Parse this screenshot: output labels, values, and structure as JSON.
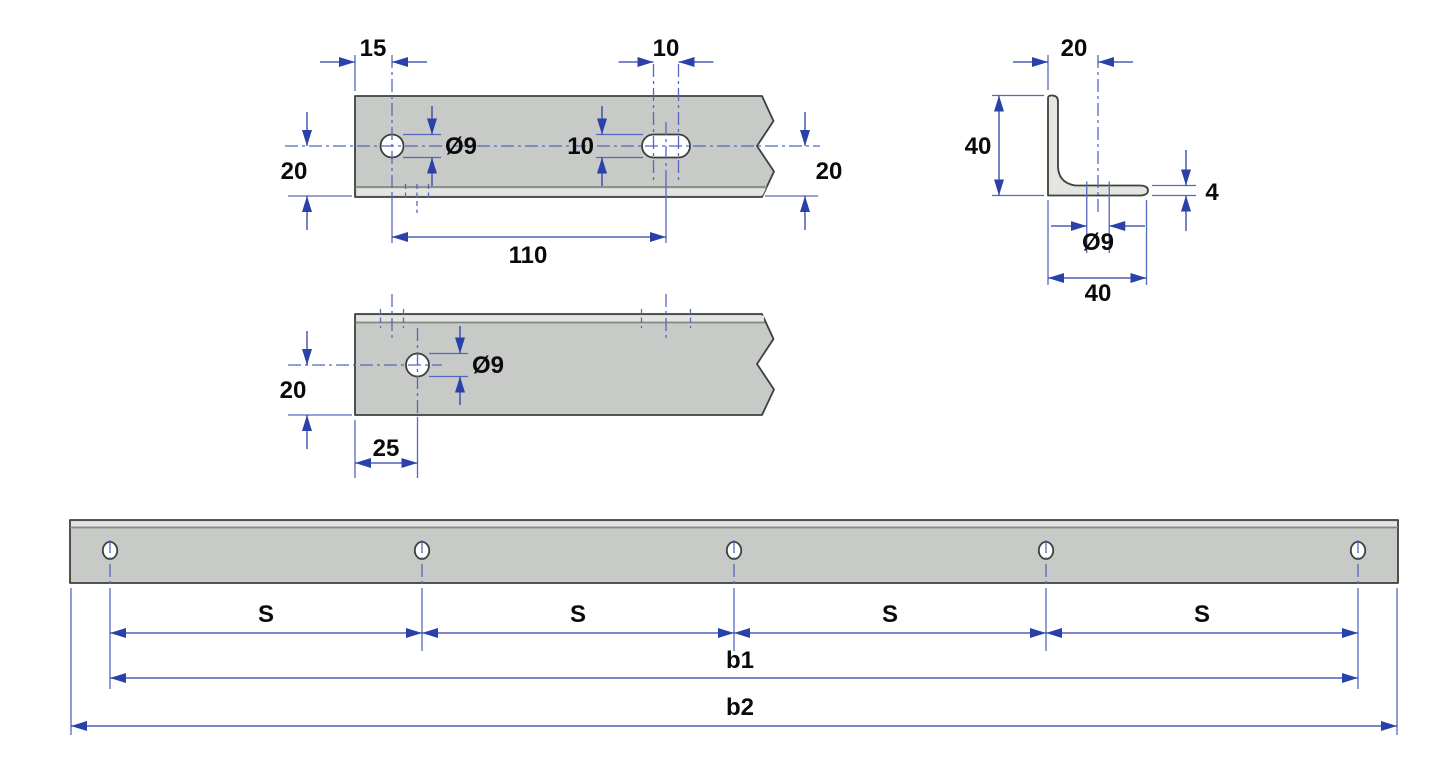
{
  "drawing": {
    "background": "#ffffff",
    "colors": {
      "part_fill": "#c7cac6",
      "part_fill_light": "#e3e5e1",
      "outline": "#3c413d",
      "dimension_blue": "#5468be",
      "arrow_blue": "#2a41a8",
      "label_text": "#0a0a0b"
    },
    "views": {
      "flat_bar_top": {
        "description": "Flat bar top view with round hole and slotted hole",
        "dims": {
          "edge_to_hole": "15",
          "slot_length": "10",
          "hole_diameter": "Ø9",
          "slot_width": "10",
          "center_to_edge_left": "20",
          "center_to_edge_right": "20",
          "hole_to_slot": "110"
        }
      },
      "angle_profile": {
        "description": "Angle bracket end profile",
        "dims": {
          "hole_offset": "20",
          "leg_height": "40",
          "thickness": "4",
          "hole_diameter": "Ø9",
          "leg_width": "40"
        }
      },
      "flat_bar_side": {
        "description": "Flat bar side view",
        "dims": {
          "center_to_edge": "20",
          "hole_diameter": "Ø9",
          "edge_to_hole": "25"
        }
      },
      "long_bar": {
        "description": "Full length bar with equally spaced holes",
        "dims": {
          "spacing_labels": [
            "S",
            "S",
            "S",
            "S"
          ],
          "hole_span": "b1",
          "overall_length": "b2"
        }
      }
    }
  }
}
